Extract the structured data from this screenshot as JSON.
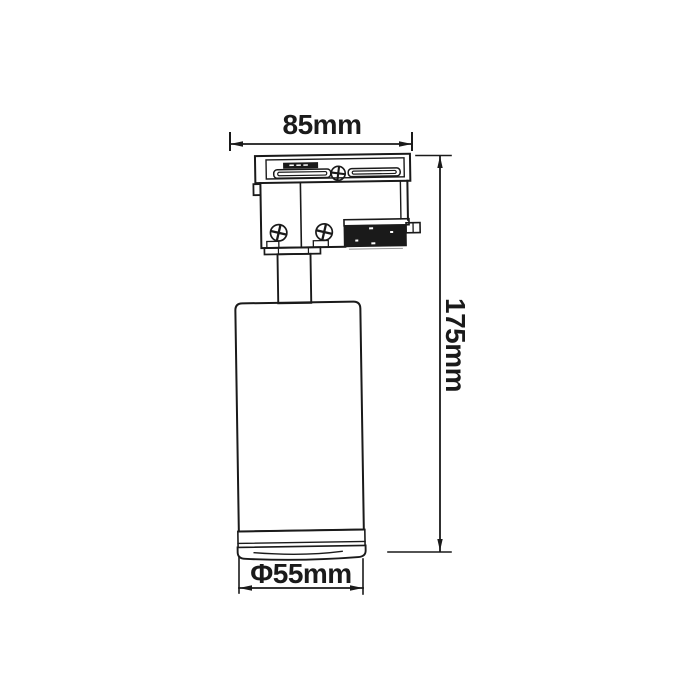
{
  "colors": {
    "ink": "#1a1a1a",
    "paper": "#ffffff"
  },
  "dimensions": {
    "width": {
      "label": "85mm"
    },
    "height": {
      "label": "175mm"
    },
    "diameter": {
      "label": "Φ55mm"
    }
  }
}
